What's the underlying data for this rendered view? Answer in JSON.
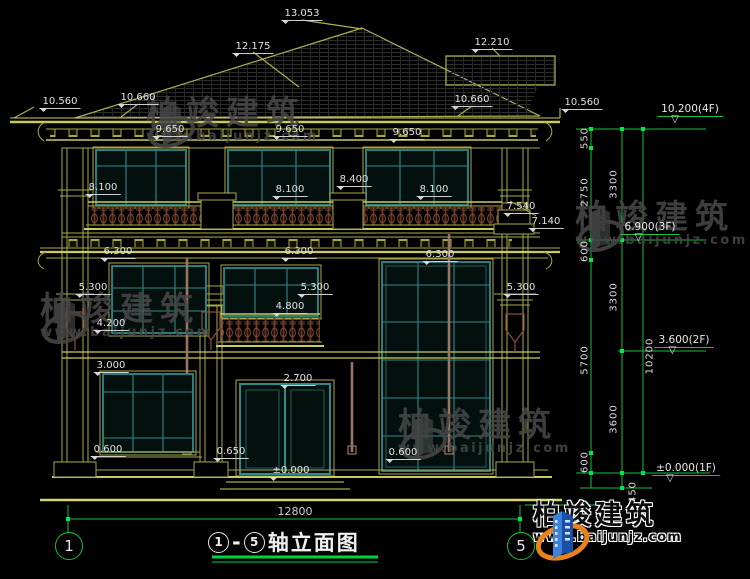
{
  "colors": {
    "background": "#000000",
    "line_yellow": "#a8a848",
    "line_yellow_bright": "#caca60",
    "window_teal": "#2f8a8a",
    "dimension_green": "#14c23c",
    "tick_green": "#00e84e",
    "text_white": "#e2e2e2",
    "baluster_brown": "#6b3a28",
    "pipe_brown": "#9b7563",
    "watermark_gray": "#474747",
    "logo_blue": "#2263c8",
    "logo_orange": "#e8821e"
  },
  "icons": {
    "dim_marker": "filled-down-triangle",
    "level_marker": "open-down-triangle",
    "axis_bubble": "green-circle",
    "brand_mark": "building-with-swoosh"
  },
  "dim_labels": [
    {
      "text": "13.053",
      "x": 302,
      "y": 8
    },
    {
      "text": "12.175",
      "x": 253,
      "y": 41
    },
    {
      "text": "12.210",
      "x": 492,
      "y": 37
    },
    {
      "text": "10.560",
      "x": 60,
      "y": 96
    },
    {
      "text": "10.660",
      "x": 138,
      "y": 92
    },
    {
      "text": "10.660",
      "x": 472,
      "y": 94
    },
    {
      "text": "10.560",
      "x": 582,
      "y": 97
    },
    {
      "text": "9.650",
      "x": 170,
      "y": 124
    },
    {
      "text": "9.650",
      "x": 290,
      "y": 124
    },
    {
      "text": "9.650",
      "x": 407,
      "y": 127
    },
    {
      "text": "8.100",
      "x": 103,
      "y": 182
    },
    {
      "text": "8.100",
      "x": 290,
      "y": 184
    },
    {
      "text": "8.400",
      "x": 354,
      "y": 174
    },
    {
      "text": "8.100",
      "x": 434,
      "y": 184
    },
    {
      "text": "7.540",
      "x": 521,
      "y": 201
    },
    {
      "text": "7.140",
      "x": 546,
      "y": 216
    },
    {
      "text": "6.300",
      "x": 118,
      "y": 246
    },
    {
      "text": "6.300",
      "x": 299,
      "y": 246
    },
    {
      "text": "6.300",
      "x": 440,
      "y": 249
    },
    {
      "text": "5.300",
      "x": 93,
      "y": 282
    },
    {
      "text": "5.300",
      "x": 315,
      "y": 282
    },
    {
      "text": "5.300",
      "x": 521,
      "y": 282
    },
    {
      "text": "4.800",
      "x": 290,
      "y": 301
    },
    {
      "text": "4.200",
      "x": 111,
      "y": 318
    },
    {
      "text": "3.000",
      "x": 111,
      "y": 360
    },
    {
      "text": "2.700",
      "x": 298,
      "y": 373
    },
    {
      "text": "0.600",
      "x": 108,
      "y": 444
    },
    {
      "text": "0.650",
      "x": 231,
      "y": 446
    },
    {
      "text": "0.600",
      "x": 403,
      "y": 447
    },
    {
      "text": "±0.000",
      "x": 291,
      "y": 465
    }
  ],
  "level_labels": [
    {
      "text": "10.200(4F)",
      "x": 690,
      "y": 103
    },
    {
      "text": "6.900(3F)",
      "x": 650,
      "y": 221
    },
    {
      "text": "3.600(2F)",
      "x": 684,
      "y": 334
    },
    {
      "text": "±0.000(1F)",
      "x": 686,
      "y": 462
    }
  ],
  "chain_dims": [
    {
      "text": "550",
      "x": 585,
      "y": 138
    },
    {
      "text": "2750",
      "x": 585,
      "y": 192
    },
    {
      "text": "600",
      "x": 585,
      "y": 251
    },
    {
      "text": "5700",
      "x": 585,
      "y": 360
    },
    {
      "text": "600",
      "x": 585,
      "y": 462
    },
    {
      "text": "3300",
      "x": 614,
      "y": 184
    },
    {
      "text": "3300",
      "x": 614,
      "y": 297
    },
    {
      "text": "3600",
      "x": 614,
      "y": 419
    },
    {
      "text": "450",
      "x": 633,
      "y": 492
    },
    {
      "text": "10200",
      "x": 650,
      "y": 356
    }
  ],
  "bottom": {
    "span_dimension": "12800",
    "axis_left": "1",
    "axis_right": "5",
    "title_axis_left": "1",
    "title_axis_right": "5",
    "title_dash": "-",
    "title_text": "轴立面图",
    "title_full": "①-⑤轴立面图"
  },
  "watermark": {
    "brand": "柏竣建筑",
    "site": "www.baijunjz.com",
    "instances": [
      {
        "x": 146,
        "y": 96
      },
      {
        "x": 575,
        "y": 200
      },
      {
        "x": 40,
        "y": 292
      },
      {
        "x": 398,
        "y": 408
      }
    ]
  },
  "brand_logo": {
    "brand": "柏竣建筑",
    "site": "www.baijunjz.com"
  }
}
